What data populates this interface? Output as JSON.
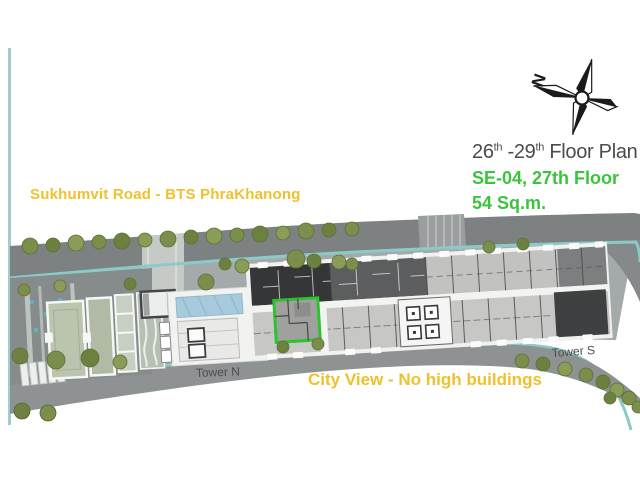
{
  "header": {
    "title": {
      "p1": "26",
      "s1": "th",
      "p2": " -29",
      "s2": "th",
      "p3": " Floor Plan"
    },
    "unit_line": "SE-04, 27th Floor",
    "area_line": "54 Sq.m."
  },
  "labels": {
    "road": "Sukhumvit Road - BTS PhraKhanong",
    "view": "City View - No high buildings",
    "tower_n": "Tower N",
    "tower_s": "Tower S",
    "compass_north": "N"
  },
  "highlighted_unit": {
    "id": "SE-04",
    "floor": "27th Floor",
    "area": "54 Sq.m.",
    "outline_color": "#2EC32E"
  },
  "colors": {
    "accent_yellow": "#EFC12C",
    "accent_green": "#3CC33C",
    "unit_highlight": "#2EC32E",
    "canal_teal": "#8CCACA",
    "road_gray": "#8F9293",
    "pool_blue": "#A7CBDC",
    "dark_units": "#353637"
  }
}
